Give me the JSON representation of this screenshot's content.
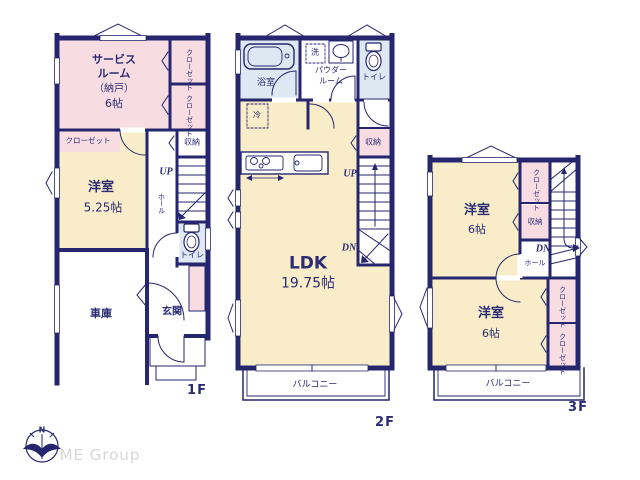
{
  "colors": {
    "wall_navy": "#26266f",
    "room_pink": "#f7dde2",
    "room_cream": "#f9edc9",
    "wet_area_blue": "#dde8f3",
    "text_navy": "#2b2b74",
    "logo_gray": "#d6d6d6"
  },
  "shared": {
    "closet": "クローゼット",
    "storage": "収納",
    "toilet": "トイレ",
    "hall": "ホール",
    "up": "UP",
    "down": "DN",
    "balcony": "バルコニー",
    "western_room": "洋室"
  },
  "floor1": {
    "label": "1F",
    "service_room": {
      "line1": "サービス",
      "line2": "ルーム",
      "line3": "（納戸）",
      "size": "6帖"
    },
    "western_room_size": "5.25帖",
    "garage": "車庫",
    "entrance": "玄関"
  },
  "floor2": {
    "label": "2F",
    "bath": "浴室",
    "wash": "洗",
    "powder": {
      "line1": "パウダー",
      "line2": "ルーム"
    },
    "fridge": "冷",
    "ldk": {
      "name": "LDK",
      "size": "19.75帖"
    }
  },
  "floor3": {
    "label": "3F",
    "room_top_size": "6帖",
    "room_bottom_size": "6帖"
  },
  "logo": {
    "compass_n": "N",
    "company": "ME Group"
  }
}
